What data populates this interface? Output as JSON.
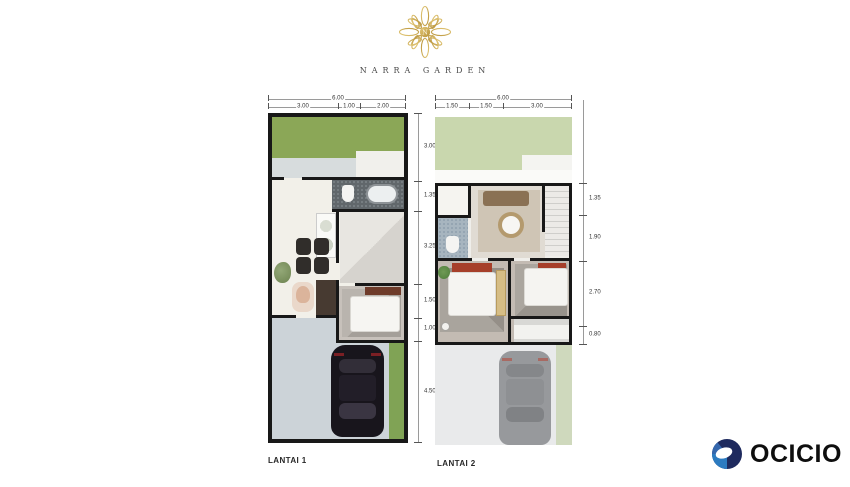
{
  "header": {
    "logo_title": "NARRA GARDEN",
    "logo_monogram": "N"
  },
  "plans": [
    {
      "label": "LANTAI 1",
      "dim_total_top": "6.00",
      "dims_top": [
        "3.00",
        "1.00",
        "2.00"
      ],
      "dims_right": [
        "3.00",
        "1.35",
        "3.25",
        "1.50",
        "1.00",
        "4.50"
      ]
    },
    {
      "label": "LANTAI 2",
      "dim_total_top": "6.00",
      "dims_top": [
        "1.50",
        "1.50",
        "3.00"
      ],
      "dims_right": [
        "1.35",
        "1.90",
        "2.70",
        "0.80"
      ]
    }
  ],
  "brand": {
    "name": "OCICIO"
  },
  "colors": {
    "logo_gold": "#C2A14C",
    "garden_green_floor1": "#8BA757",
    "garden_green_floor2": "#C9D7AE",
    "accent_red": "#A63F2A",
    "brand_navy": "#1E2A5E",
    "brand_blue": "#2C7BC0",
    "wall_black": "#181818",
    "carport_gray": "#CCD3D8"
  }
}
